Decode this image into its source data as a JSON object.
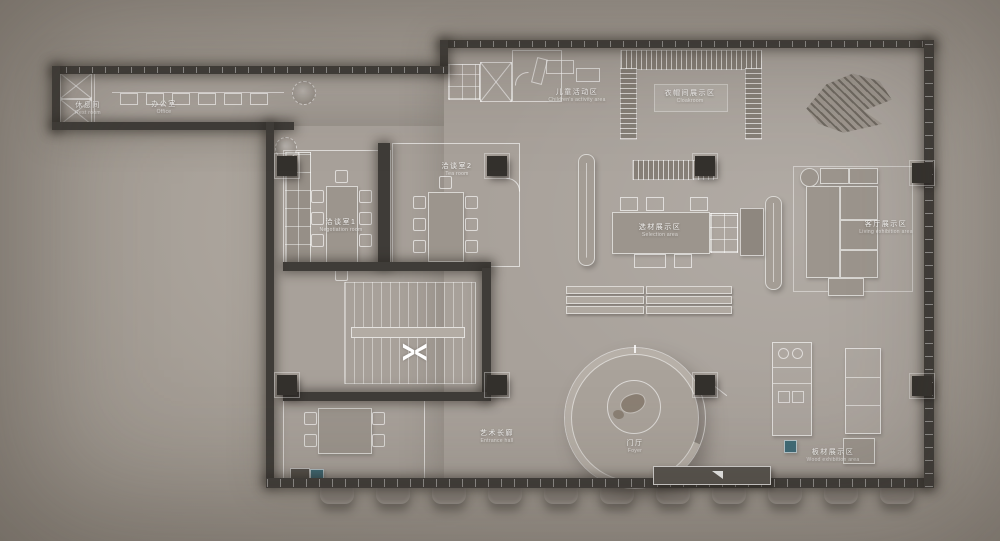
{
  "title": "Furniture showroom floor plan",
  "colors": {
    "background": "#aca59d",
    "wall": "#3f3c38",
    "floor": "#a8a19a",
    "outline": "#ffffff",
    "accent_teal": "#3f6b77"
  },
  "rooms": {
    "rest": {
      "cn": "休息间",
      "en": "Rest room"
    },
    "office": {
      "cn": "办公室",
      "en": "Office"
    },
    "children": {
      "cn": "儿童活动区",
      "en": "Children's activity area"
    },
    "cloakroom": {
      "cn": "衣帽间展示区",
      "en": "Cloakroom"
    },
    "meeting1": {
      "cn": "洽谈室1",
      "en": "Negotiation room"
    },
    "meeting2": {
      "cn": "洽谈室2",
      "en": "Tea room"
    },
    "selection": {
      "cn": "选材展示区",
      "en": "Selection area"
    },
    "living": {
      "cn": "客厅展示区",
      "en": "Living exhibition area"
    },
    "gallery": {
      "cn": "艺术长廊",
      "en": "Entrance hall"
    },
    "foyer": {
      "cn": "门厅",
      "en": "Foyer"
    },
    "wood": {
      "cn": "板材展示区",
      "en": "Wood exhibition area"
    }
  },
  "markers": {
    "stair_direction": "><"
  }
}
